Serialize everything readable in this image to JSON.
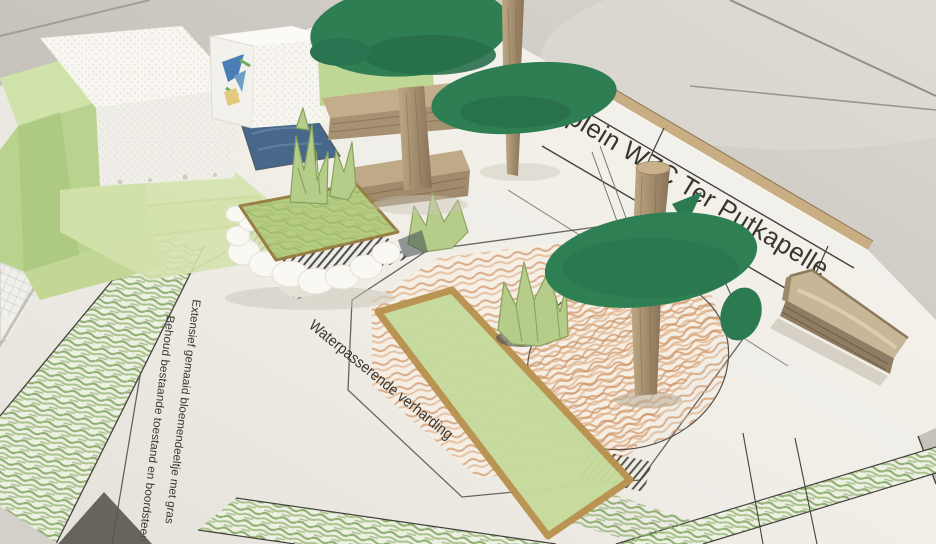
{
  "scene": {
    "type": "photograph",
    "subject": "Paper and cardboard landscape-architecture model standing on a printed site plan, photographed on a grey tiled floor"
  },
  "plan_labels": {
    "title_partial": "plein WZC Ter Putkapelle",
    "paving": "Waterpasserende verharding",
    "meadow_line1": "Extensief gemaaid bloemendeeltje met gras",
    "meadow_line2": "Behoud bestaande toestand en boordsteen"
  },
  "palette": {
    "floor_grey": "#cbc7c0",
    "paper_white": "#f2f0e9",
    "canopy_green": "#2d7b52",
    "building_paper_green": "#bcd693",
    "origami_green": "#b6cd8a",
    "crayon_green": "#85a863",
    "crayon_orange": "#cd8f5e",
    "ochre_border": "#b9924f",
    "pond_blue": "#47688a",
    "cardboard_tan": "#b3a184",
    "wood_dowel": "#a8906f",
    "cotton_white": "#f8f7f2",
    "print_ink": "#3a3733"
  }
}
